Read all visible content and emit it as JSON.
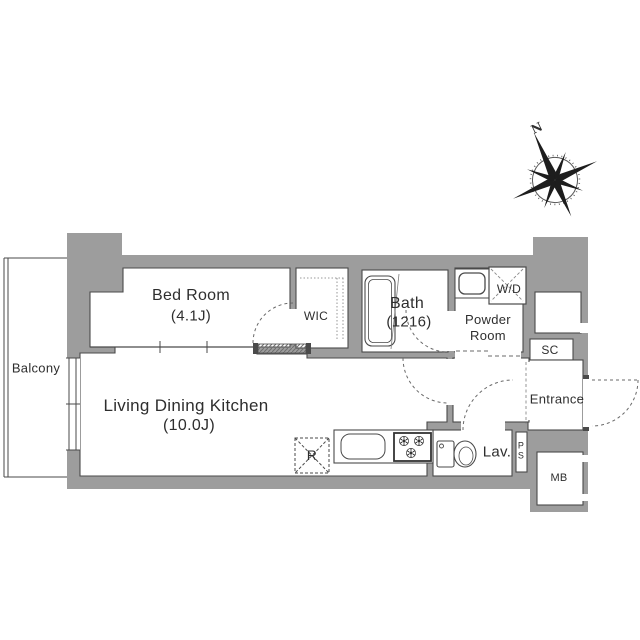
{
  "title": "Apartment floor plan",
  "colors": {
    "wall": "#9d9d9d",
    "line": "#4a4a4a",
    "dash": "#777777",
    "text": "#2e2e2e"
  },
  "compass": {
    "north_label": "N"
  },
  "rooms": {
    "balcony": "Balcony",
    "bed_room": {
      "name": "Bed Room",
      "size": "(4.1J)"
    },
    "wic": "WIC",
    "bath": {
      "name": "Bath",
      "size": "(1216)"
    },
    "washer_dryer": "W/D",
    "powder_room": "Powder\nRoom",
    "shoe_closet": "SC",
    "entrance": "Entrance",
    "lavatory": "Lav.",
    "pipe_space": "P\nS",
    "meter_box": "MB",
    "ldk": {
      "name": "Living Dining Kitchen",
      "size": "(10.0J)"
    },
    "refrigerator": "R"
  }
}
